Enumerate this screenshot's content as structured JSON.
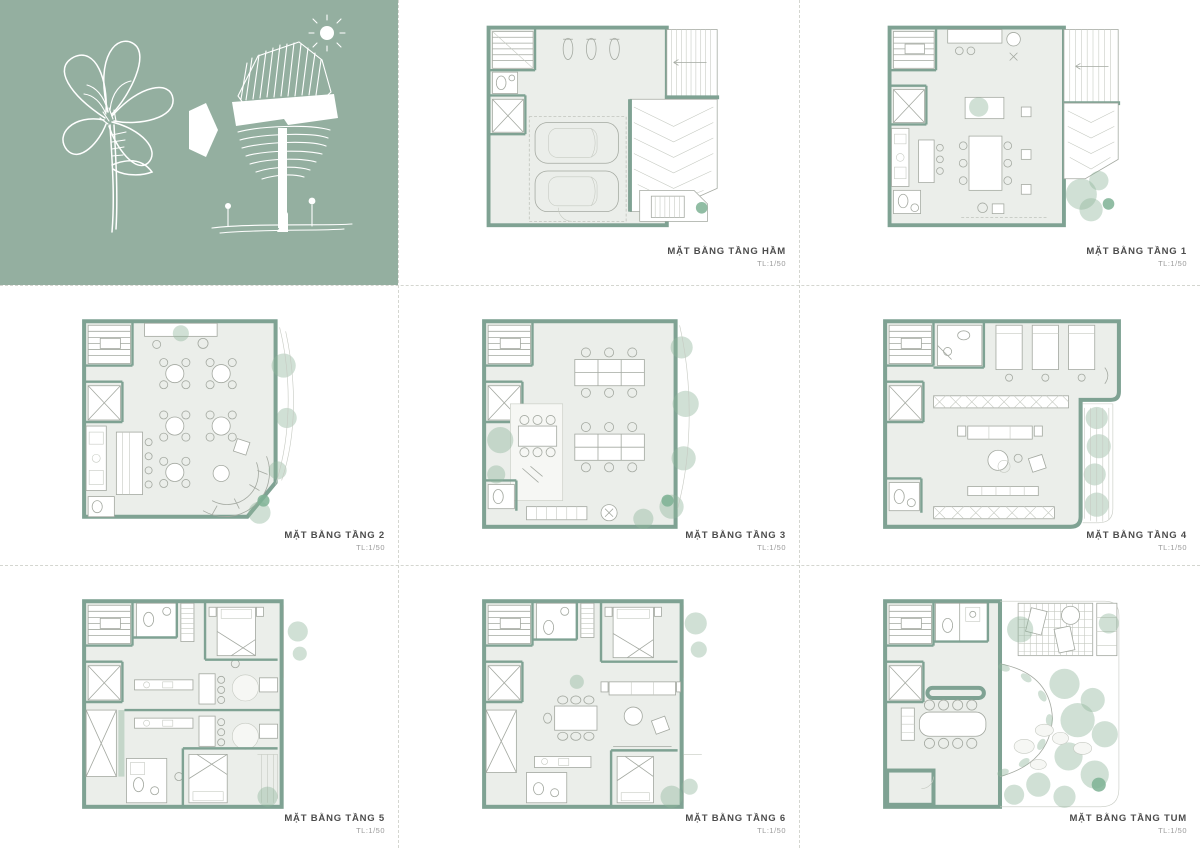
{
  "concept_panel": {
    "background_color": "#94afa0",
    "sketch_items": [
      {
        "name": "lily-flower-sketch"
      },
      {
        "name": "arrow"
      },
      {
        "name": "tree-house-concept-sketch"
      },
      {
        "name": "sun"
      },
      {
        "name": "ground-line-with-figures"
      }
    ]
  },
  "plans": [
    {
      "label": "MẶT BẰNG TẦNG HẦM",
      "scale": "TL:1/50"
    },
    {
      "label": "MẶT BẰNG TẦNG 1",
      "scale": "TL:1/50"
    },
    {
      "label": "MẶT BẰNG TẦNG 2",
      "scale": "TL:1/50"
    },
    {
      "label": "MẶT BẰNG TẦNG 3",
      "scale": "TL:1/50"
    },
    {
      "label": "MẶT BẰNG TẦNG 4",
      "scale": "TL:1/50"
    },
    {
      "label": "MẶT BẰNG TẦNG 5",
      "scale": "TL:1/50"
    },
    {
      "label": "MẶT BẰNG TẦNG 6",
      "scale": "TL:1/50"
    },
    {
      "label": "MẶT BẰNG TẦNG TUM",
      "scale": "TL:1/50"
    }
  ],
  "colors": {
    "panel_green": "#94afa0",
    "wall_green": "#7fa293",
    "floor": "#ebeeea",
    "foliage": "#8fb59a",
    "label_text": "#4c4c4c"
  }
}
